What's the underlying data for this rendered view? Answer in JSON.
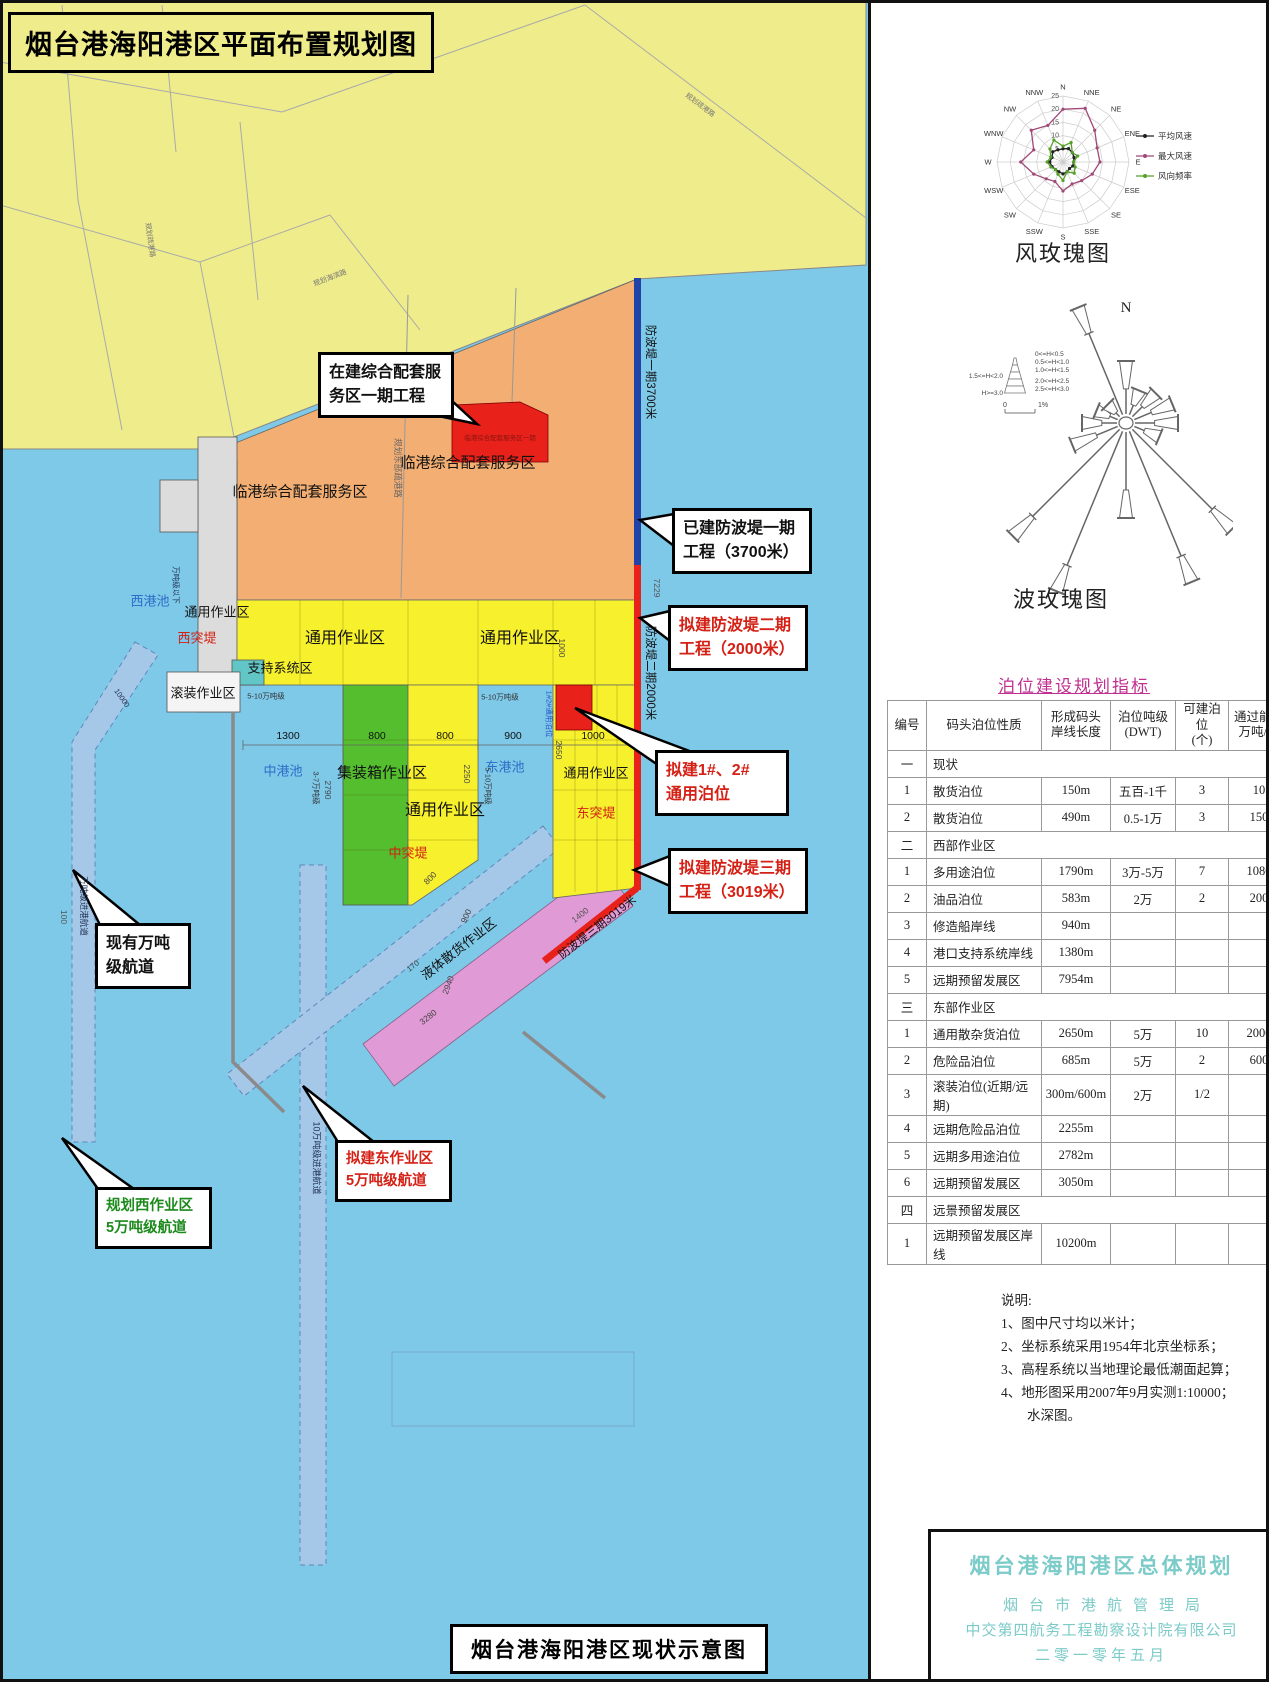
{
  "doc": {
    "title": "烟台港海阳港区平面布置规划图",
    "caption": "烟台港海阳港区现状示意图"
  },
  "map": {
    "colors": {
      "sea": "#7EC8E8",
      "land": "#EFEC8B",
      "work_yellow": "#F6F02D",
      "orange": "#F2AE73",
      "green": "#54BE2E",
      "pink": "#E09AD6",
      "red": "#E8211A",
      "breakwater_blue": "#2143A8",
      "channel": "#A6C8E8",
      "pier_gray": "#DCDCDC",
      "teal": "#62C6C6",
      "basin_text": "#2E6CC8",
      "magenta": "#C03090",
      "title_block_text": "#7BCBC8"
    },
    "labels": [
      {
        "t": "临港综合配套服务区",
        "x": 300,
        "y": 491,
        "s": 15
      },
      {
        "t": "临港综合配套服务区",
        "x": 468,
        "y": 462,
        "s": 15
      },
      {
        "t": "临港综合配套服务区一期",
        "x": 500,
        "y": 437,
        "s": 6.5,
        "c": "#8a1510"
      },
      {
        "t": "通用作业区",
        "x": 217,
        "y": 611,
        "s": 13
      },
      {
        "t": "西港池",
        "x": 150,
        "y": 600,
        "s": 13,
        "c": "#2E6CC8"
      },
      {
        "t": "西突堤",
        "x": 197,
        "y": 637,
        "s": 13,
        "c": "#D42015"
      },
      {
        "t": "通用作业区",
        "x": 345,
        "y": 636,
        "s": 16
      },
      {
        "t": "通用作业区",
        "x": 520,
        "y": 636,
        "s": 16
      },
      {
        "t": "支持系统区",
        "x": 280,
        "y": 667,
        "s": 13
      },
      {
        "t": "滚装作业区",
        "x": 203,
        "y": 692,
        "s": 13
      },
      {
        "t": "集装箱作业区",
        "x": 382,
        "y": 772,
        "s": 15
      },
      {
        "t": "中港池",
        "x": 283,
        "y": 770,
        "s": 13,
        "c": "#2E6CC8"
      },
      {
        "t": "东港池",
        "x": 505,
        "y": 766,
        "s": 13,
        "c": "#2E6CC8"
      },
      {
        "t": "通用作业区",
        "x": 596,
        "y": 772,
        "s": 13
      },
      {
        "t": "通用作业区",
        "x": 445,
        "y": 808,
        "s": 16
      },
      {
        "t": "中突堤",
        "x": 408,
        "y": 852,
        "s": 13,
        "c": "#D42015"
      },
      {
        "t": "东突堤",
        "x": 596,
        "y": 812,
        "s": 13,
        "c": "#D42015"
      },
      {
        "t": "液体散货作业区",
        "x": 458,
        "y": 948,
        "s": 13,
        "r": -38
      },
      {
        "t": "防波堤一期3700米",
        "x": 651,
        "y": 372,
        "s": 11.5,
        "r": 90
      },
      {
        "t": "防波堤二期2000米",
        "x": 651,
        "y": 673,
        "s": 11.5,
        "r": 90
      },
      {
        "t": "防波堤三期3019米",
        "x": 597,
        "y": 927,
        "s": 11.5,
        "r": -38
      },
      {
        "t": "7229",
        "x": 657,
        "y": 588,
        "s": 8.5,
        "r": 90,
        "c": "#555"
      },
      {
        "t": "1400",
        "x": 580,
        "y": 915,
        "s": 8.5,
        "r": -38,
        "c": "#555"
      },
      {
        "t": "万吨级进港航道",
        "x": 84,
        "y": 906,
        "s": 8.5,
        "r": 90,
        "c": "#223355"
      },
      {
        "t": "100",
        "x": 64,
        "y": 917,
        "s": 8.5,
        "r": 90,
        "c": "#555"
      },
      {
        "t": "10万吨级进港航道",
        "x": 317,
        "y": 1158,
        "s": 9,
        "r": 90,
        "c": "#223355"
      },
      {
        "t": "万吨级以下",
        "x": 176,
        "y": 585,
        "s": 7.5,
        "r": 90,
        "c": "#223355"
      },
      {
        "t": "10000",
        "x": 122,
        "y": 698,
        "s": 7.5,
        "r": 55,
        "c": "#223355"
      },
      {
        "t": "5-10万吨级",
        "x": 266,
        "y": 696,
        "s": 7.5,
        "c": "#333"
      },
      {
        "t": "5-10万吨级",
        "x": 500,
        "y": 697,
        "s": 7.5,
        "c": "#333"
      },
      {
        "t": "3-7万吨级",
        "x": 316,
        "y": 788,
        "s": 7.5,
        "r": 90,
        "c": "#333"
      },
      {
        "t": "2790",
        "x": 328,
        "y": 790,
        "s": 8.5,
        "r": 90,
        "c": "#444"
      },
      {
        "t": "2250",
        "x": 467,
        "y": 774,
        "s": 8.5,
        "r": 90,
        "c": "#444"
      },
      {
        "t": "2650",
        "x": 559,
        "y": 750,
        "s": 8.5,
        "r": 90,
        "c": "#444"
      },
      {
        "t": "5-10万吨级",
        "x": 488,
        "y": 786,
        "s": 7.5,
        "r": 90,
        "c": "#333"
      },
      {
        "t": "1#2#通用泊位",
        "x": 549,
        "y": 714,
        "s": 7.5,
        "r": 90,
        "c": "#2255CC"
      },
      {
        "t": "1300",
        "x": 288,
        "y": 736,
        "s": 10.5
      },
      {
        "t": "800",
        "x": 377,
        "y": 736,
        "s": 10.5
      },
      {
        "t": "800",
        "x": 445,
        "y": 736,
        "s": 10.5
      },
      {
        "t": "900",
        "x": 513,
        "y": 736,
        "s": 10.5
      },
      {
        "t": "1000",
        "x": 593,
        "y": 736,
        "s": 10.5
      },
      {
        "t": "1000",
        "x": 562,
        "y": 648,
        "s": 8.5,
        "r": 90,
        "c": "#444"
      },
      {
        "t": "800",
        "x": 430,
        "y": 878,
        "s": 8.5,
        "r": -45,
        "c": "#444"
      },
      {
        "t": "900",
        "x": 466,
        "y": 916,
        "s": 8.5,
        "r": -65,
        "c": "#444"
      },
      {
        "t": "170",
        "x": 413,
        "y": 966,
        "s": 8,
        "r": -38,
        "c": "#444"
      },
      {
        "t": "2940",
        "x": 448,
        "y": 985,
        "s": 8.5,
        "r": -70,
        "c": "#444"
      },
      {
        "t": "3280",
        "x": 428,
        "y": 1017,
        "s": 8.5,
        "r": -38,
        "c": "#444"
      },
      {
        "t": "规划东部疏港路",
        "x": 398,
        "y": 468,
        "s": 8.5,
        "r": 90,
        "c": "#666"
      },
      {
        "t": "规划海滨路",
        "x": 330,
        "y": 278,
        "s": 7,
        "r": -21,
        "c": "#777"
      },
      {
        "t": "规划疏港路",
        "x": 700,
        "y": 105,
        "s": 7,
        "r": 37,
        "c": "#777"
      },
      {
        "t": "规划疏港路",
        "x": 150,
        "y": 240,
        "s": 7,
        "r": 82,
        "c": "#777"
      }
    ],
    "callouts": [
      {
        "name": "callout-service-area-phase1",
        "lines": [
          "在建综合配套服",
          "务区一期工程"
        ],
        "x": 318,
        "y": 352,
        "w": 114,
        "fs": 16,
        "color": "#111",
        "tail": "477,424 400,408 438,388"
      },
      {
        "name": "callout-breakwater-1",
        "lines": [
          "已建防波堤一期",
          "工程（3700米）"
        ],
        "x": 672,
        "y": 508,
        "w": 118,
        "fs": 16,
        "color": "#111",
        "tail": "640,520 674,514 674,546"
      },
      {
        "name": "callout-breakwater-2",
        "lines": [
          "拟建防波堤二期",
          "工程（2000米）"
        ],
        "x": 668,
        "y": 605,
        "w": 118,
        "fs": 16,
        "color": "#D42015",
        "tail": "640,618 670,611 670,641"
      },
      {
        "name": "callout-berth-1-2",
        "lines": [
          "拟建1#、2#",
          "通用泊位"
        ],
        "x": 655,
        "y": 750,
        "w": 112,
        "fs": 16,
        "color": "#D42015",
        "tail": "575,708 658,765 692,752"
      },
      {
        "name": "callout-breakwater-3",
        "lines": [
          "拟建防波堤三期",
          "工程（3019米）"
        ],
        "x": 668,
        "y": 848,
        "w": 118,
        "fs": 16,
        "color": "#D42015",
        "tail": "634,870 670,856 670,886"
      },
      {
        "name": "callout-existing-channel",
        "lines": [
          "现有万吨",
          "级航道"
        ],
        "x": 95,
        "y": 923,
        "w": 74,
        "fs": 16,
        "color": "#111",
        "tail": "73,870 100,925 140,925"
      },
      {
        "name": "callout-east-channel",
        "lines": [
          "拟建东作业区",
          "5万吨级航道"
        ],
        "x": 335,
        "y": 1140,
        "w": 95,
        "fs": 14.5,
        "color": "#D42015",
        "tail": "303,1086 338,1142 374,1142"
      },
      {
        "name": "callout-west-channel",
        "lines": [
          "规划西作业区",
          "5万吨级航道"
        ],
        "x": 95,
        "y": 1187,
        "w": 95,
        "fs": 14.5,
        "color": "#1B8A1B",
        "tail": "62,1138 98,1189 134,1189"
      }
    ]
  },
  "chart_data": [
    {
      "type": "radar-wind-rose",
      "title": "风玫瑰图",
      "directions": [
        "N",
        "NNE",
        "NE",
        "ENE",
        "E",
        "ESE",
        "SE",
        "SSE",
        "S",
        "SSW",
        "SW",
        "WSW",
        "W",
        "WNW",
        "NW",
        "NNW"
      ],
      "ring_values": [
        5,
        10,
        15,
        20,
        25
      ],
      "series": [
        {
          "name": "平均风速",
          "color": "#222222",
          "values": [
            5,
            5.5,
            5,
            4.5,
            4,
            4,
            3.5,
            4,
            4.5,
            4,
            4,
            4.5,
            5,
            4.5,
            5.5,
            5
          ]
        },
        {
          "name": "最大风速",
          "color": "#A04878",
          "values": [
            20,
            22,
            17,
            14,
            14,
            12,
            10,
            9,
            11,
            8,
            9,
            12,
            16,
            12,
            17,
            15
          ]
        },
        {
          "name": "风向频率",
          "color": "#55A028",
          "values": [
            6,
            8,
            5,
            6,
            4,
            5,
            6,
            4,
            7,
            5,
            4,
            5,
            6,
            5,
            7,
            9
          ]
        }
      ]
    },
    {
      "type": "wave-rose",
      "title": "波玫瑰图",
      "north_label": "N",
      "legend_left": [
        "1.5<=H<2.0",
        "H>=3.0"
      ],
      "legend_right": [
        "0<=H<0.5",
        "0.5<=H<1.0",
        "1.0<=H<1.5",
        "2.0<=H<2.5",
        "2.5<=H<3.0"
      ],
      "scale_labels": [
        "0",
        "1%"
      ],
      "rays": [
        {
          "dir": 0,
          "len": 62
        },
        {
          "dir": 22.5,
          "len": 35
        },
        {
          "dir": 45,
          "len": 42
        },
        {
          "dir": 67.5,
          "len": 50
        },
        {
          "dir": 90,
          "len": 52
        },
        {
          "dir": 112.5,
          "len": 36
        },
        {
          "dir": 135,
          "len": 150
        },
        {
          "dir": 157.5,
          "len": 172
        },
        {
          "dir": 180,
          "len": 95
        },
        {
          "dir": 202.5,
          "len": 182
        },
        {
          "dir": 225,
          "len": 160
        },
        {
          "dir": 247.5,
          "len": 58
        },
        {
          "dir": 270,
          "len": 44
        },
        {
          "dir": 292.5,
          "len": 32
        },
        {
          "dir": 315,
          "len": 26
        },
        {
          "dir": 337.5,
          "len": 125
        }
      ]
    }
  ],
  "berth_table": {
    "title": "泊位建设规划指标",
    "headers": [
      [
        "编号"
      ],
      [
        "码头泊位性质"
      ],
      [
        "形成码头",
        "岸线长度"
      ],
      [
        "泊位吨级",
        "(DWT)"
      ],
      [
        "可建泊位",
        "(个)"
      ],
      [
        "通过能力",
        "万吨/年"
      ]
    ],
    "rows": [
      {
        "sec": "一",
        "label": "现状"
      },
      {
        "n": "1",
        "name": "散货泊位",
        "len": "150m",
        "dwt": "五百-1千",
        "cnt": "3",
        "cap": "10"
      },
      {
        "n": "2",
        "name": "散货泊位",
        "len": "490m",
        "dwt": "0.5-1万",
        "cnt": "3",
        "cap": "150"
      },
      {
        "sec": "二",
        "label": "西部作业区"
      },
      {
        "n": "1",
        "name": "多用途泊位",
        "len": "1790m",
        "dwt": "3万-5万",
        "cnt": "7",
        "cap": "1080"
      },
      {
        "n": "2",
        "name": "油品泊位",
        "len": "583m",
        "dwt": "2万",
        "cnt": "2",
        "cap": "200"
      },
      {
        "n": "3",
        "name": "修造船岸线",
        "len": "940m",
        "dwt": "",
        "cnt": "",
        "cap": ""
      },
      {
        "n": "4",
        "name": "港口支持系统岸线",
        "len": "1380m",
        "dwt": "",
        "cnt": "",
        "cap": ""
      },
      {
        "n": "5",
        "name": "远期预留发展区",
        "len": "7954m",
        "dwt": "",
        "cnt": "",
        "cap": ""
      },
      {
        "sec": "三",
        "label": "东部作业区"
      },
      {
        "n": "1",
        "name": "通用散杂货泊位",
        "len": "2650m",
        "dwt": "5万",
        "cnt": "10",
        "cap": "2000"
      },
      {
        "n": "2",
        "name": "危险品泊位",
        "len": "685m",
        "dwt": "5万",
        "cnt": "2",
        "cap": "600"
      },
      {
        "n": "3",
        "name": "滚装泊位(近期/远期)",
        "len": "300m/600m",
        "dwt": "2万",
        "cnt": "1/2",
        "cap": ""
      },
      {
        "n": "4",
        "name": "远期危险品泊位",
        "len": "2255m",
        "dwt": "",
        "cnt": "",
        "cap": ""
      },
      {
        "n": "5",
        "name": "远期多用途泊位",
        "len": "2782m",
        "dwt": "",
        "cnt": "",
        "cap": ""
      },
      {
        "n": "6",
        "name": "远期预留发展区",
        "len": "3050m",
        "dwt": "",
        "cnt": "",
        "cap": ""
      },
      {
        "sec": "四",
        "label": "远景预留发展区"
      },
      {
        "n": "1",
        "name": "远期预留发展区岸线",
        "len": "10200m",
        "dwt": "",
        "cnt": "",
        "cap": ""
      }
    ]
  },
  "notes": {
    "heading": "说明:",
    "items": [
      "1、图中尺寸均以米计；",
      "2、坐标系统采用1954年北京坐标系；",
      "3、高程系统以当地理论最低潮面起算；",
      "4、地形图采用2007年9月实测1:10000；",
      "水深图。"
    ]
  },
  "title_block": {
    "lines": [
      "烟台港海阳港区总体规划",
      "烟台市港航管理局",
      "中交第四航务工程勘察设计院有限公司",
      "二零一零年五月"
    ]
  }
}
